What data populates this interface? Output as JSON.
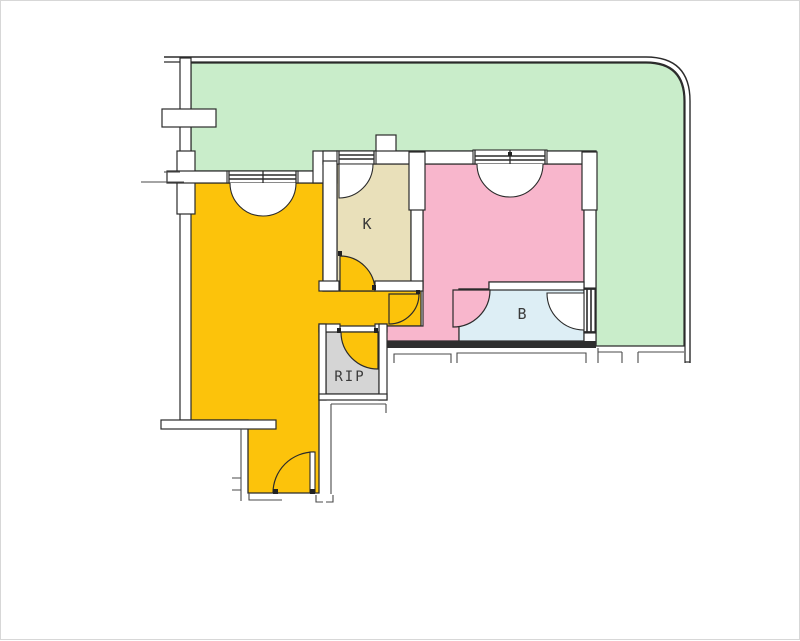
{
  "floorplan": {
    "line_color": "#2b2b2b",
    "thin_line_color": "#4a4a4a",
    "wall_fill": "#ffffff",
    "thick_wall_color": "#2e2e2e",
    "rooms": {
      "living": {
        "color": "#fcc30b"
      },
      "kitchen": {
        "label": "K",
        "color": "#e9e0ba"
      },
      "bedroom": {
        "color": "#f8b6cc"
      },
      "bathroom": {
        "label": "B",
        "color": "#ddeef5"
      },
      "storage": {
        "label": "RIP",
        "color": "#d5d5d5"
      },
      "balcony": {
        "color": "#c9edca"
      }
    }
  }
}
